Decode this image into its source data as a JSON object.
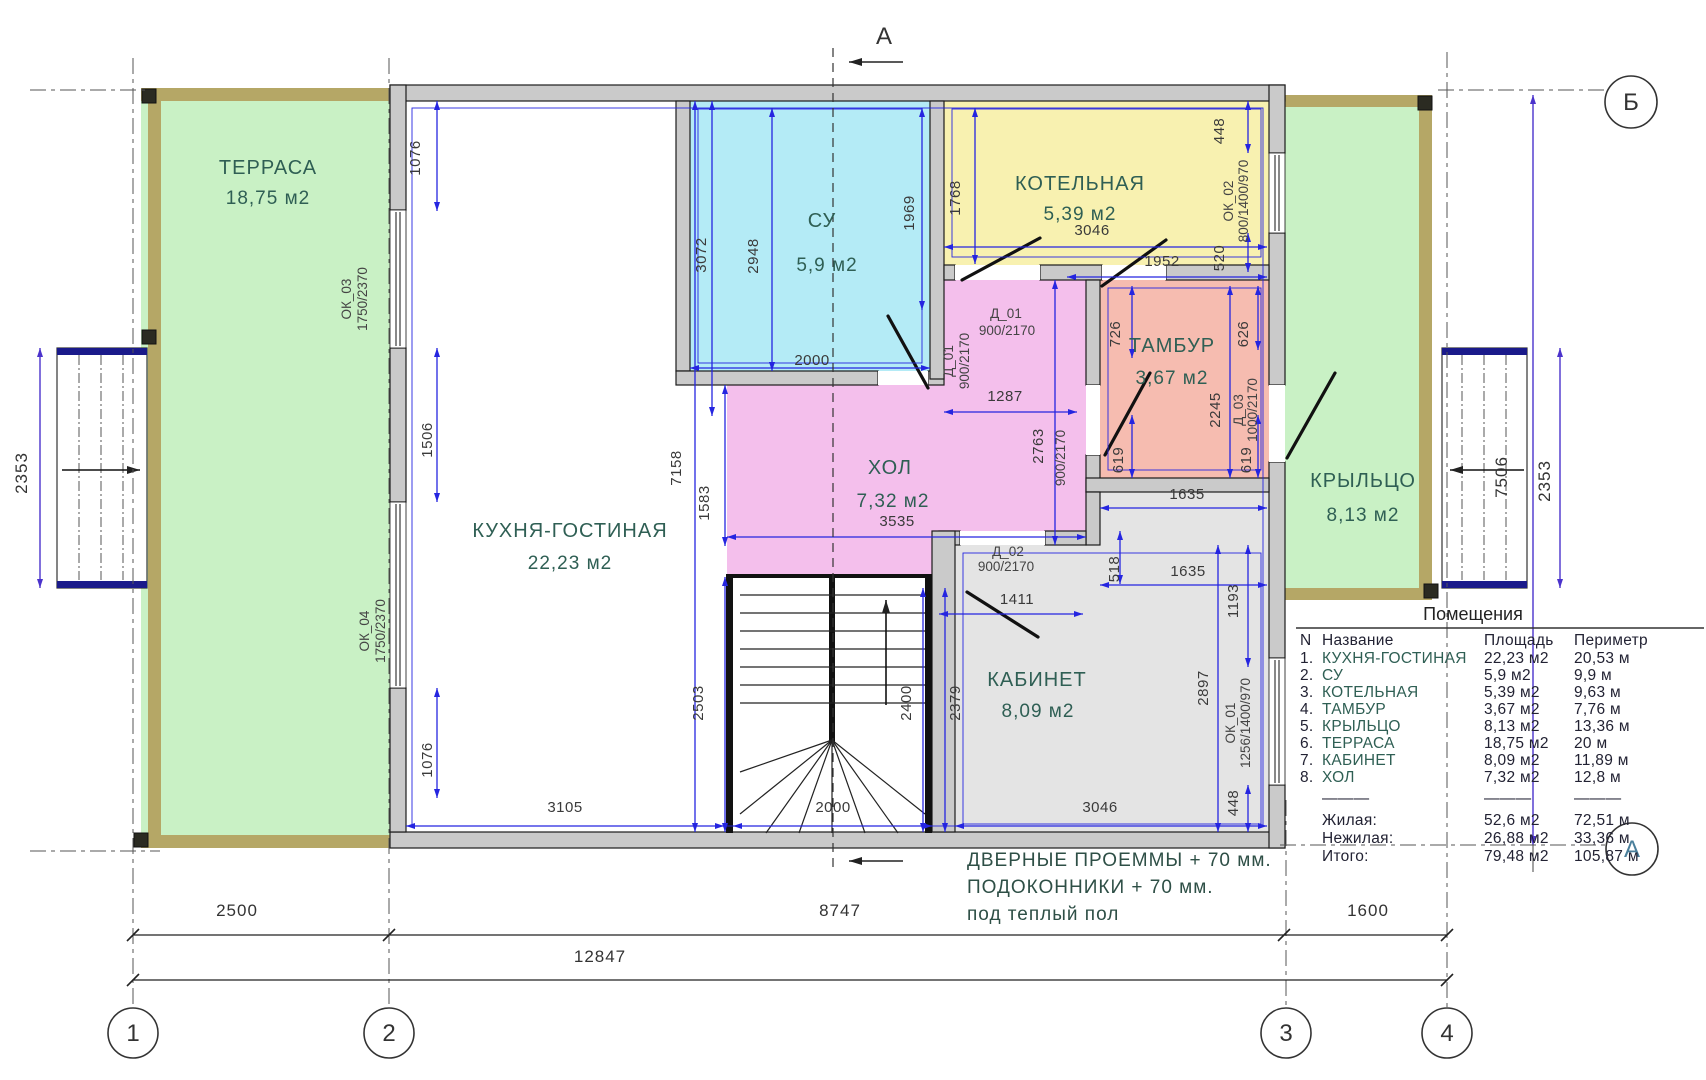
{
  "axes": {
    "cols": [
      "1",
      "2",
      "3",
      "4"
    ],
    "row_top": "Б",
    "row_bottom": "А",
    "section": "А"
  },
  "rooms": {
    "terrace": {
      "name": "ТЕРРАСА",
      "area": "18,75 м2"
    },
    "kitchen": {
      "name": "КУХНЯ-ГОСТИНАЯ",
      "area": "22,23 м2"
    },
    "su": {
      "name": "СУ",
      "area": "5,9 м2"
    },
    "boiler": {
      "name": "КОТЕЛЬНАЯ",
      "area": "5,39 м2"
    },
    "tambur": {
      "name": "ТАМБУР",
      "area": "3,67 м2"
    },
    "hall": {
      "name": "ХОЛ",
      "area": "7,32 м2"
    },
    "cabinet": {
      "name": "КАБИНЕТ",
      "area": "8,09 м2"
    },
    "porch": {
      "name": "КРЫЛЬЦО",
      "area": "8,13 м2"
    }
  },
  "openings": {
    "ok01": {
      "name": "ОК_01",
      "size": "1256/1400/970"
    },
    "ok02": {
      "name": "ОК_02",
      "size": "800/1400/970"
    },
    "ok03": {
      "name": "ОК_03",
      "size": "1750/2370"
    },
    "ok04": {
      "name": "ОК_04",
      "size": "1750/2370"
    },
    "d01": {
      "name": "Д_01",
      "size": "900/2170"
    },
    "d02": {
      "name": "Д_02",
      "size": "900/2170"
    },
    "d03": {
      "name": "Д_03",
      "size": "1000/2170"
    },
    "door_hall_tambur": {
      "size": "900/2170"
    }
  },
  "dims": {
    "bottom_seg1": "2500",
    "bottom_seg2": "8747",
    "bottom_seg3": "1600",
    "bottom_total": "12847",
    "steps_left": "2353",
    "steps_right": "2353",
    "right_total": "7506",
    "left_top": "1076",
    "left_mid": "1506",
    "left_bottom": "1076",
    "su_height": "3072",
    "su_inner_height": "2948",
    "su_right_height": "1969",
    "su_width": "2000",
    "interior_height": "7158",
    "hall_left": "1583",
    "kitchen_lower": "2503",
    "kitchen_width": "3105",
    "boiler_left": "1768",
    "boiler_width": "3046",
    "boiler_lower": "1952",
    "right_top": "448",
    "right_mid": "520",
    "tambur_left_top": "726",
    "tambur_right_top": "626",
    "tambur_height": "2245",
    "tambur_left_bot": "619",
    "tambur_right_bot": "619",
    "tambur_width": "1635",
    "below_tambur": "518",
    "below_tambur_width": "1635",
    "hall_arm_width": "1287",
    "hall_width": "3535",
    "hall_right_height": "2763",
    "cabinet_right": "1193",
    "cabinet_height": "2897",
    "cabinet_width": "3046",
    "cabinet_door": "1411",
    "right_bottom": "448",
    "stairs_width": "2000",
    "stairs_height": "2400",
    "stairs_right": "2379"
  },
  "notes": {
    "line1": "ДВЕРНЫЕ ПРОЕММЫ + 70 мм.",
    "line2": "ПОДОКОННИКИ + 70 мм.",
    "line3": "под теплый пол"
  },
  "table": {
    "title": "Помещения",
    "headers": {
      "n": "N",
      "name": "Название",
      "area": "Площадь",
      "perimeter": "Периметр"
    },
    "separator": "———",
    "rows": [
      {
        "num": "1.",
        "name": "КУХНЯ-ГОСТИНАЯ",
        "area": "22,23 м2",
        "perimeter": "20,53 м"
      },
      {
        "num": "2.",
        "name": "СУ",
        "area": "5,9 м2",
        "perimeter": "9,9 м"
      },
      {
        "num": "3.",
        "name": "КОТЕЛЬНАЯ",
        "area": "5,39 м2",
        "perimeter": "9,63 м"
      },
      {
        "num": "4.",
        "name": "ТАМБУР",
        "area": "3,67 м2",
        "perimeter": "7,76 м"
      },
      {
        "num": "5.",
        "name": "КРЫЛЬЦО",
        "area": "8,13 м2",
        "perimeter": "13,36 м"
      },
      {
        "num": "6.",
        "name": "ТЕРРАСА",
        "area": "18,75 м2",
        "perimeter": "20 м"
      },
      {
        "num": "7.",
        "name": "КАБИНЕТ",
        "area": "8,09 м2",
        "perimeter": "11,89 м"
      },
      {
        "num": "8.",
        "name": "ХОЛ",
        "area": "7,32 м2",
        "perimeter": "12,8 м"
      }
    ],
    "totals": [
      {
        "label": "Жилая:",
        "area": "52,6 м2",
        "perimeter": "72,51 м"
      },
      {
        "label": "Нежилая:",
        "area": "26,88 м2",
        "perimeter": "33,36 м"
      },
      {
        "label": "Итого:",
        "area": "79,48 м2",
        "perimeter": "105,87 м"
      }
    ]
  }
}
